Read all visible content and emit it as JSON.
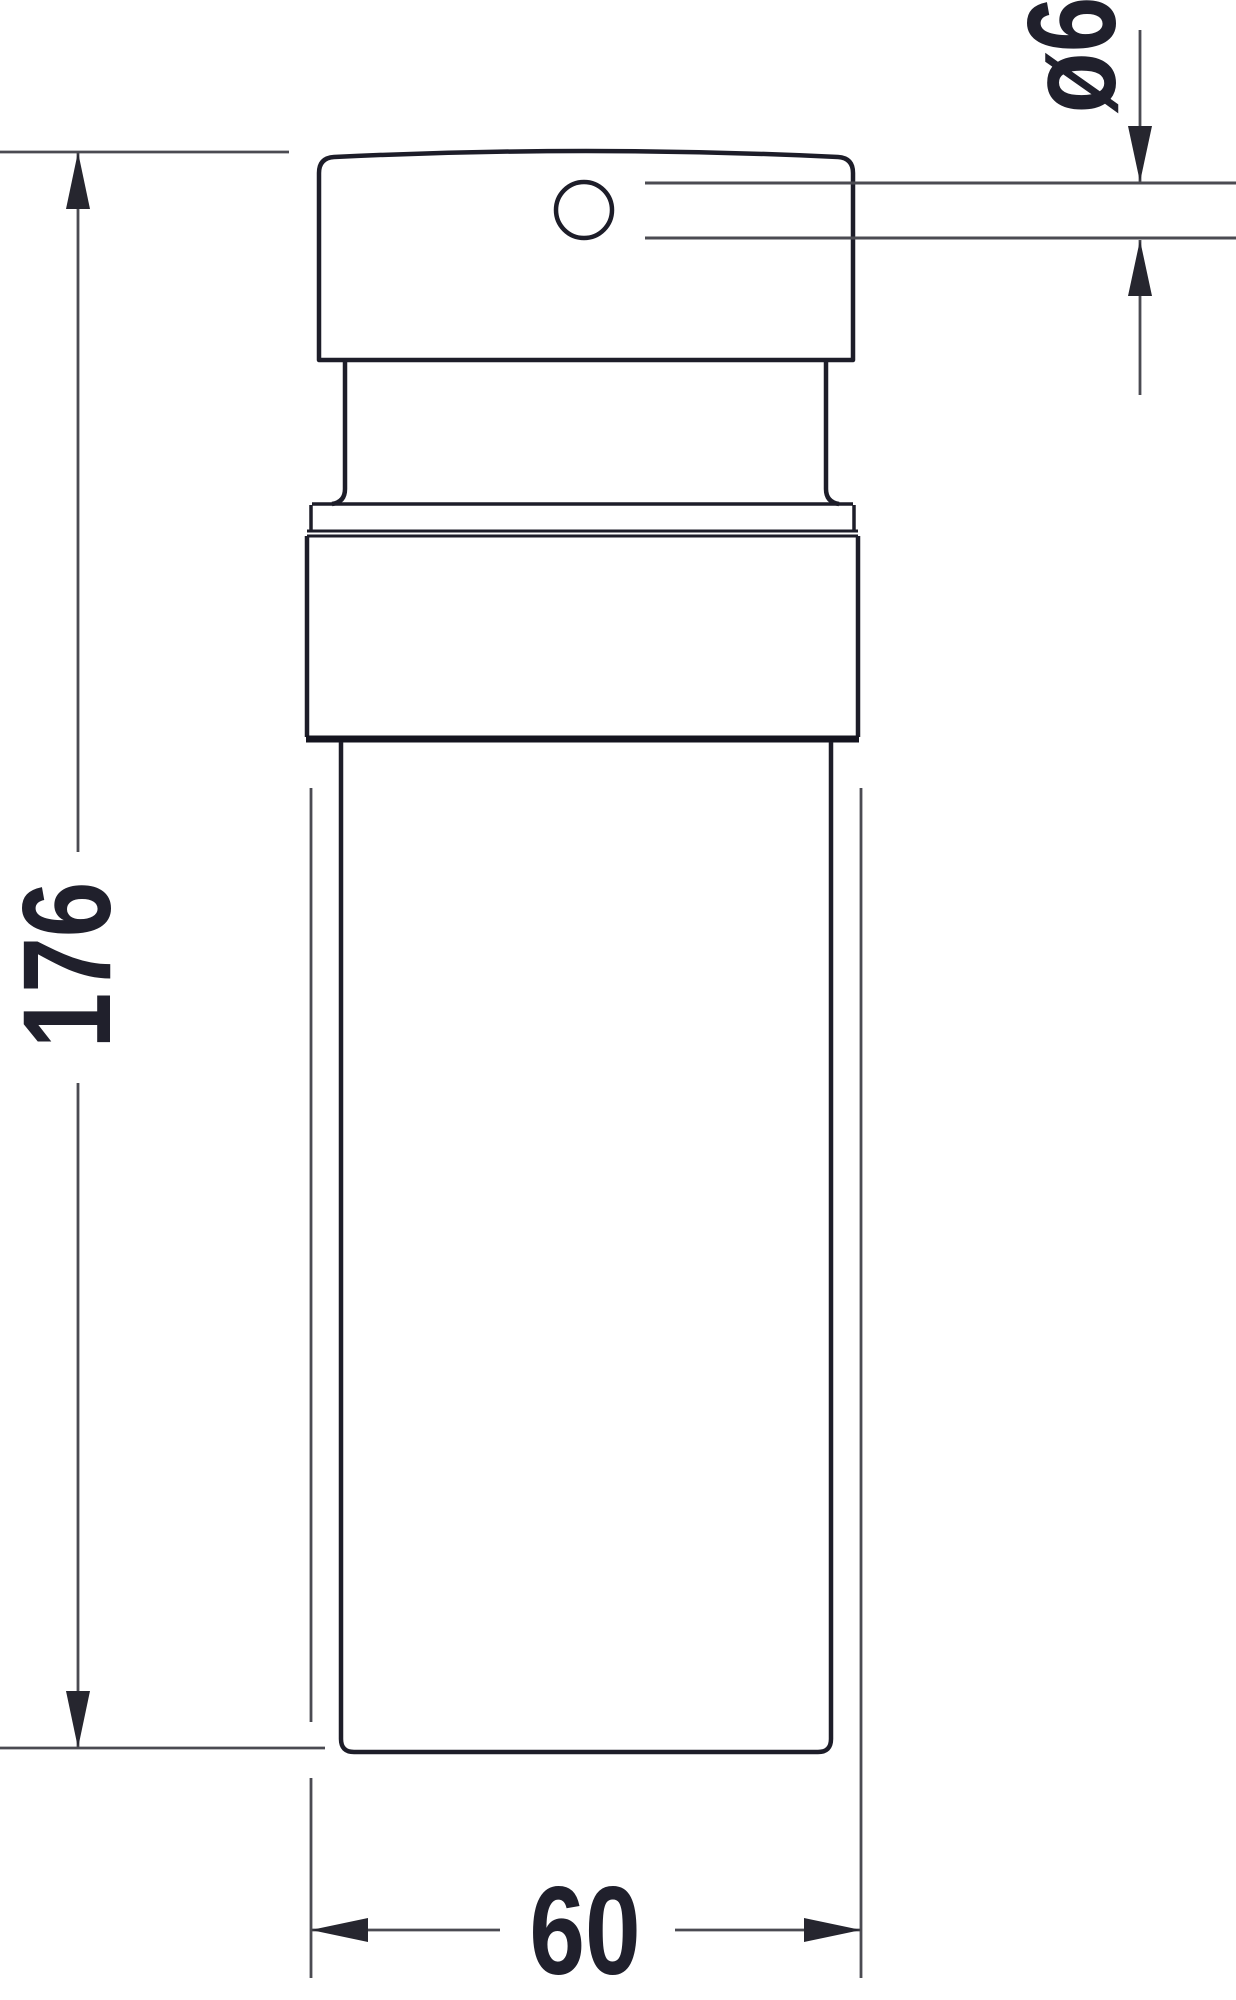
{
  "drawing": {
    "type": "technical-dimension-drawing",
    "subject": "soap-dispenser-side-view",
    "labels": {
      "height": "176",
      "width": "60",
      "spout_diameter": "ø6"
    },
    "colors": {
      "background": "#ffffff",
      "object_line": "#1d1d29",
      "object_line_heavy": "#14141f",
      "dim_line": "#4b4b52",
      "arrow_fill": "#26262f",
      "text": "#20202c"
    }
  }
}
